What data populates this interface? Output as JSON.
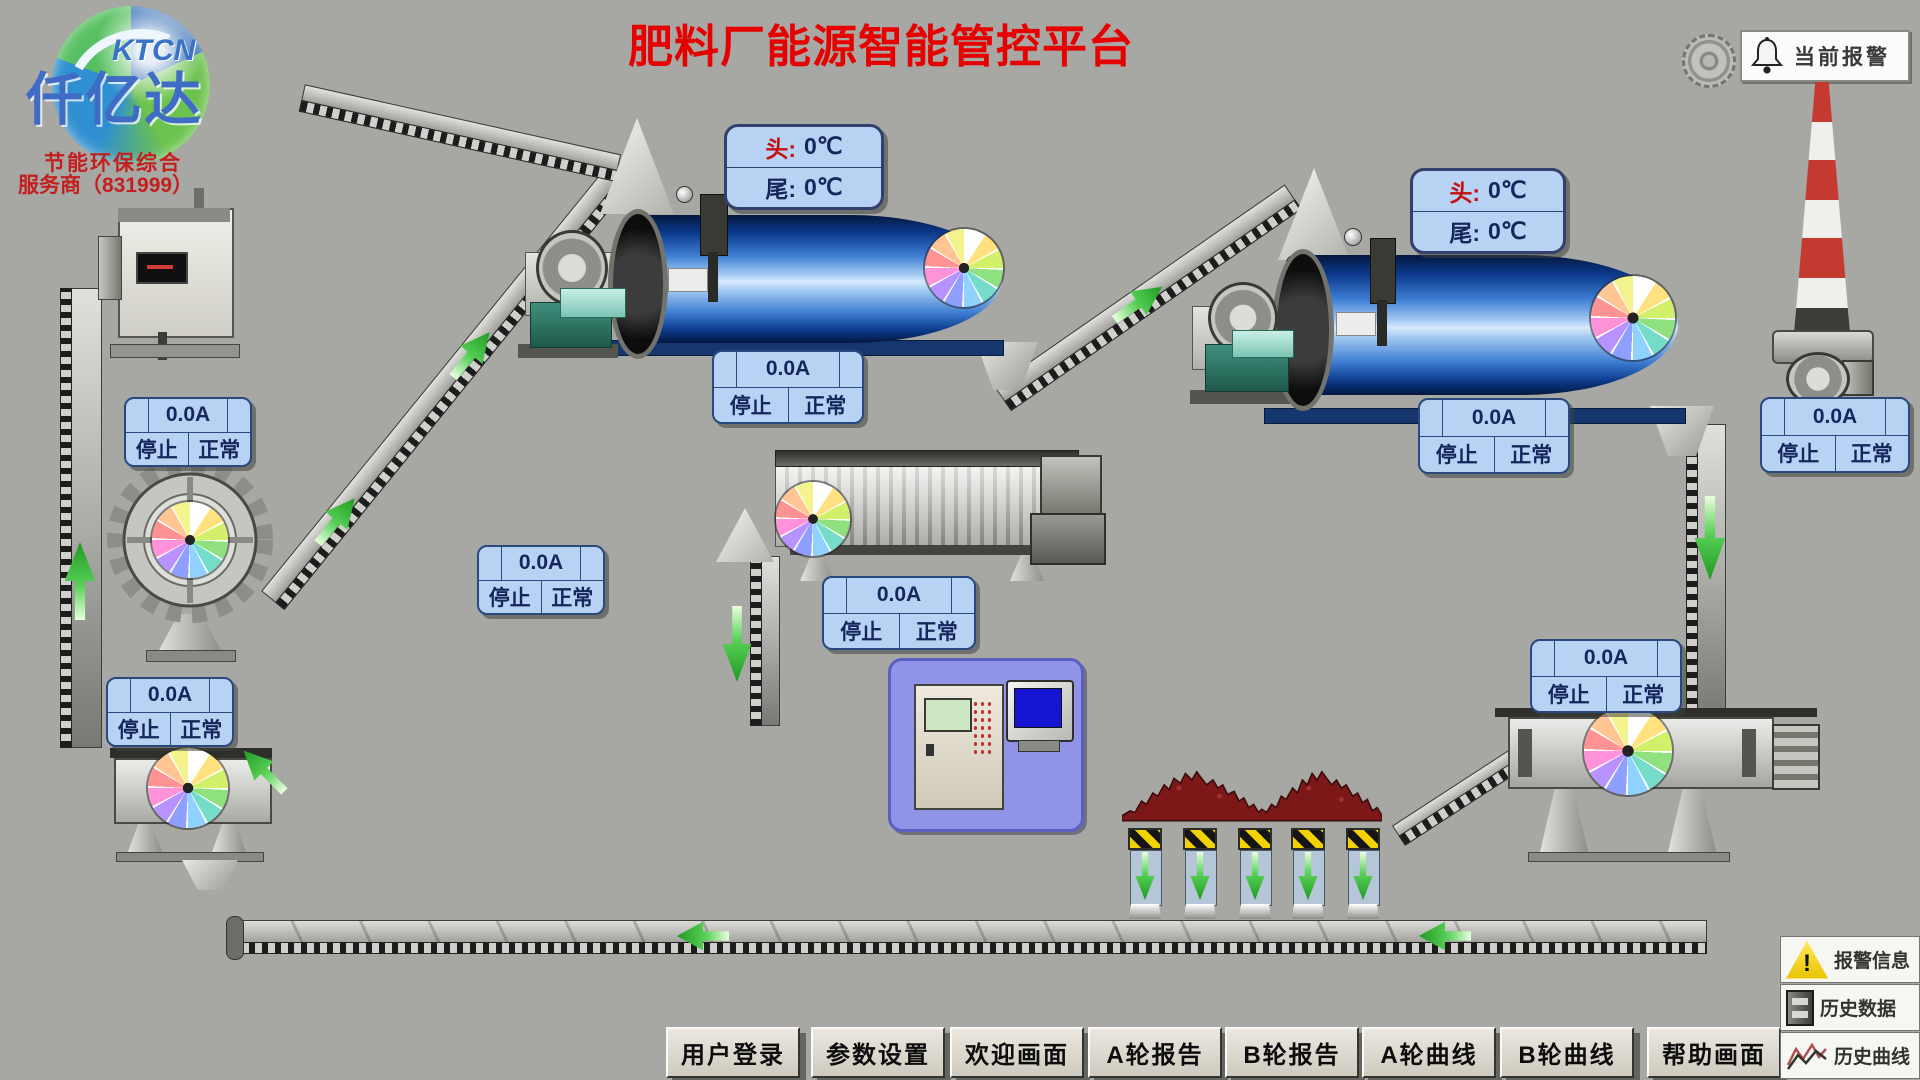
{
  "header": {
    "title": "肥料厂能源智能管控平台",
    "alarm_button_label": "当前报警"
  },
  "logo": {
    "brand_en": "KTCN",
    "brand_cn": "仟亿达",
    "tagline_line1": "节能环保综合",
    "tagline_line2": "服务商（831999）"
  },
  "temp_panel": {
    "head_label": "头:",
    "head_value": "0℃",
    "tail_label": "尾:",
    "tail_value": "0℃"
  },
  "status_panel": {
    "current": "0.0A",
    "run_state": "停止",
    "health_state": "正常"
  },
  "nav": {
    "buttons": [
      "用户登录",
      "参数设置",
      "欢迎画面",
      "A轮报告",
      "B轮报告",
      "A轮曲线",
      "B轮曲线",
      "帮助画面"
    ]
  },
  "utility": {
    "alarm_info": "报警信息",
    "history_data": "历史数据",
    "history_curve": "历史曲线",
    "warning_mark": "!"
  },
  "icons": {
    "bell": "bell-icon",
    "target_rings": "target-rings-icon",
    "warning_triangle": "warning-triangle-icon",
    "archive_cabinet": "archive-cabinet-icon",
    "zigzag_curve": "zigzag-curve-icon"
  },
  "colors": {
    "title_red": "#e60000",
    "panel_blue_fill": "#b7d2f2",
    "panel_blue_border": "#27497e",
    "drum_blue": "#2a64c0",
    "arrow_green": "#3ec43e",
    "hazard_yellow": "#f2d200",
    "pile_maroon": "#7c1818"
  }
}
